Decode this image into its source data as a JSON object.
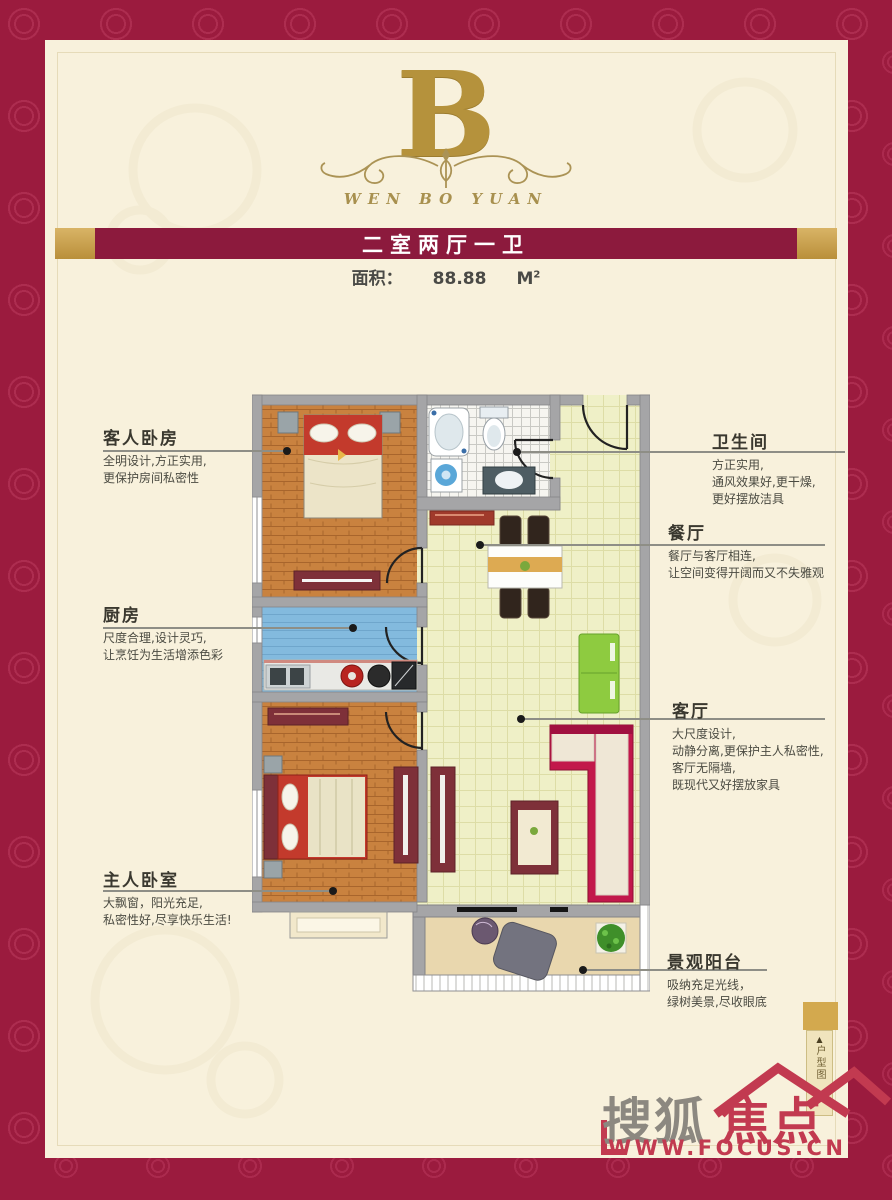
{
  "poster": {
    "block_letter": "B",
    "brand_name": "WEN BO YUAN",
    "banner_title": "二室两厅一卫",
    "area": {
      "label": "面积：",
      "value": "88.88",
      "unit": "M",
      "unit_sup": "2"
    }
  },
  "rooms": [
    {
      "name": "客人卧房",
      "desc": "全明设计,方正实用,\n更保护房间私密性"
    },
    {
      "name": "厨房",
      "desc": "尺度合理,设计灵巧,\n让烹饪为生活增添色彩"
    },
    {
      "name": "主人卧室",
      "desc": "大飘窗，阳光充足,\n私密性好,尽享快乐生活!"
    },
    {
      "name": "卫生间",
      "desc": "方正实用,\n通风效果好,更干燥,\n更好摆放洁具"
    },
    {
      "name": "餐厅",
      "desc": "餐厅与客厅相连,\n让空间变得开阔而又不失雅观"
    },
    {
      "name": "客厅",
      "desc": "大尺度设计,\n动静分离,更保护主人私密性,\n客厅无隔墙,\n既现代又好摆放家具"
    },
    {
      "name": "景观阳台",
      "desc": "吸纳充足光线，\n绿树美景,尽收眼底"
    }
  ],
  "side_tab": {
    "arrow": "▲",
    "text": "户型图"
  },
  "footer_logo": {
    "brand_gray": "搜狐",
    "brand_red": "焦点",
    "url": "WWW.FOCUS.CN"
  },
  "colors": {
    "frame": "#9b1b3e",
    "panel": "#f8f1dc",
    "banner": "#8c1a3d",
    "gold": "#c9a24d",
    "logo_red": "#c23a50"
  }
}
